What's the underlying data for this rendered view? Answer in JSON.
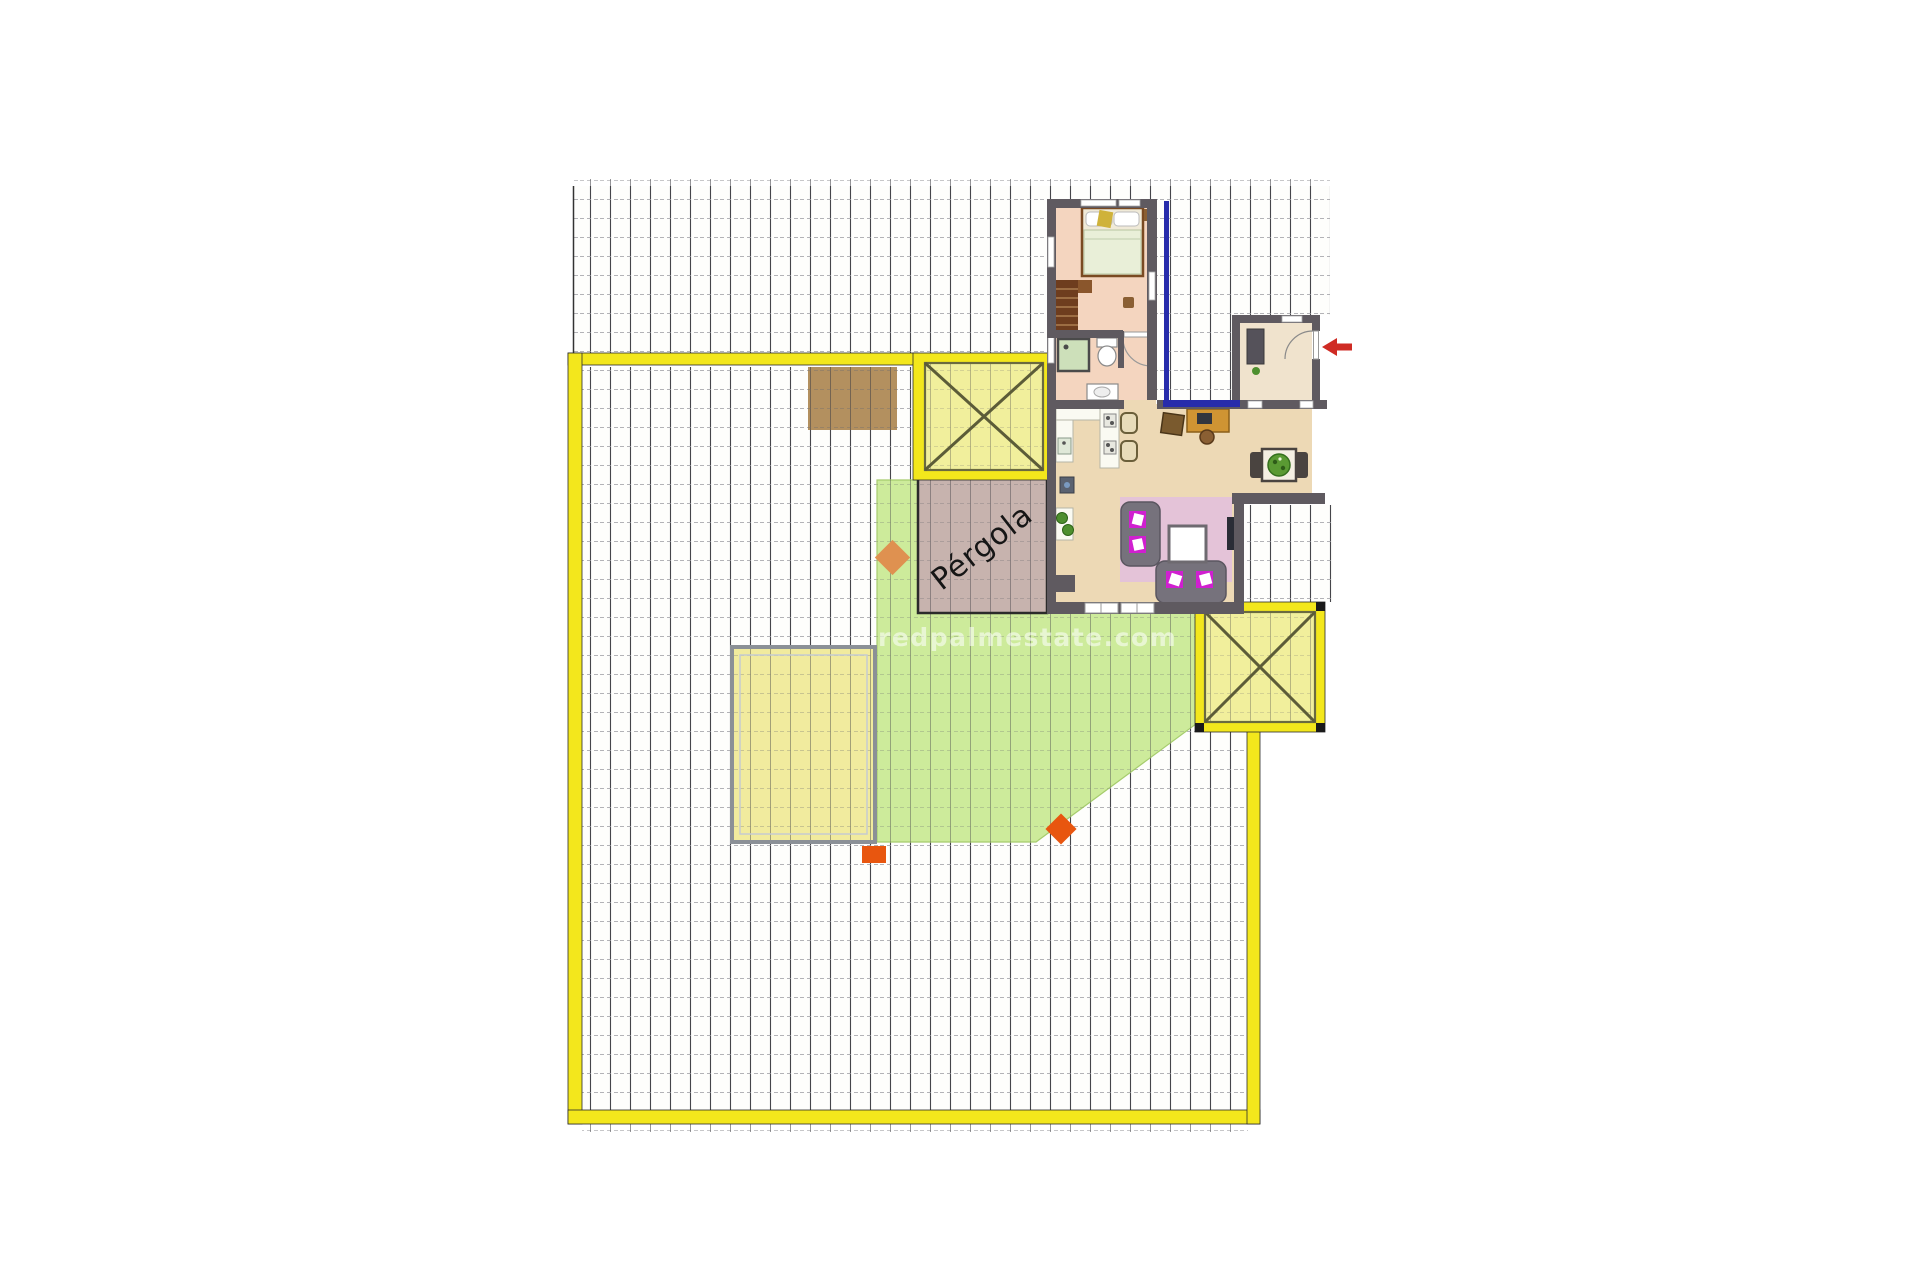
{
  "plan": {
    "pergola_label": "Pérgola",
    "watermark_text": "redpalmestate.com"
  },
  "colors": {
    "boundary_yellow": "#f3e71c",
    "square_fill": "#f1ef9c",
    "lawn_green": "#cdeb9b",
    "pool_fill": "#f1eb9e",
    "pergola_fill": "#c7b3ae",
    "wall_gray": "#5f5a60",
    "terrace_blue": "#272cab",
    "arrow_red": "#cf2b24",
    "marker_orange": "#e8560f",
    "marker_soft_orange": "#df9150",
    "rug_pink": "#e4c3d8",
    "cushion_magenta": "#d01fd0",
    "wood_floor": "#edd9b5",
    "bedroom_floor": "#f4d5bf",
    "entrance_floor": "#f0e3cd",
    "brown_patch": "#b3905f"
  }
}
